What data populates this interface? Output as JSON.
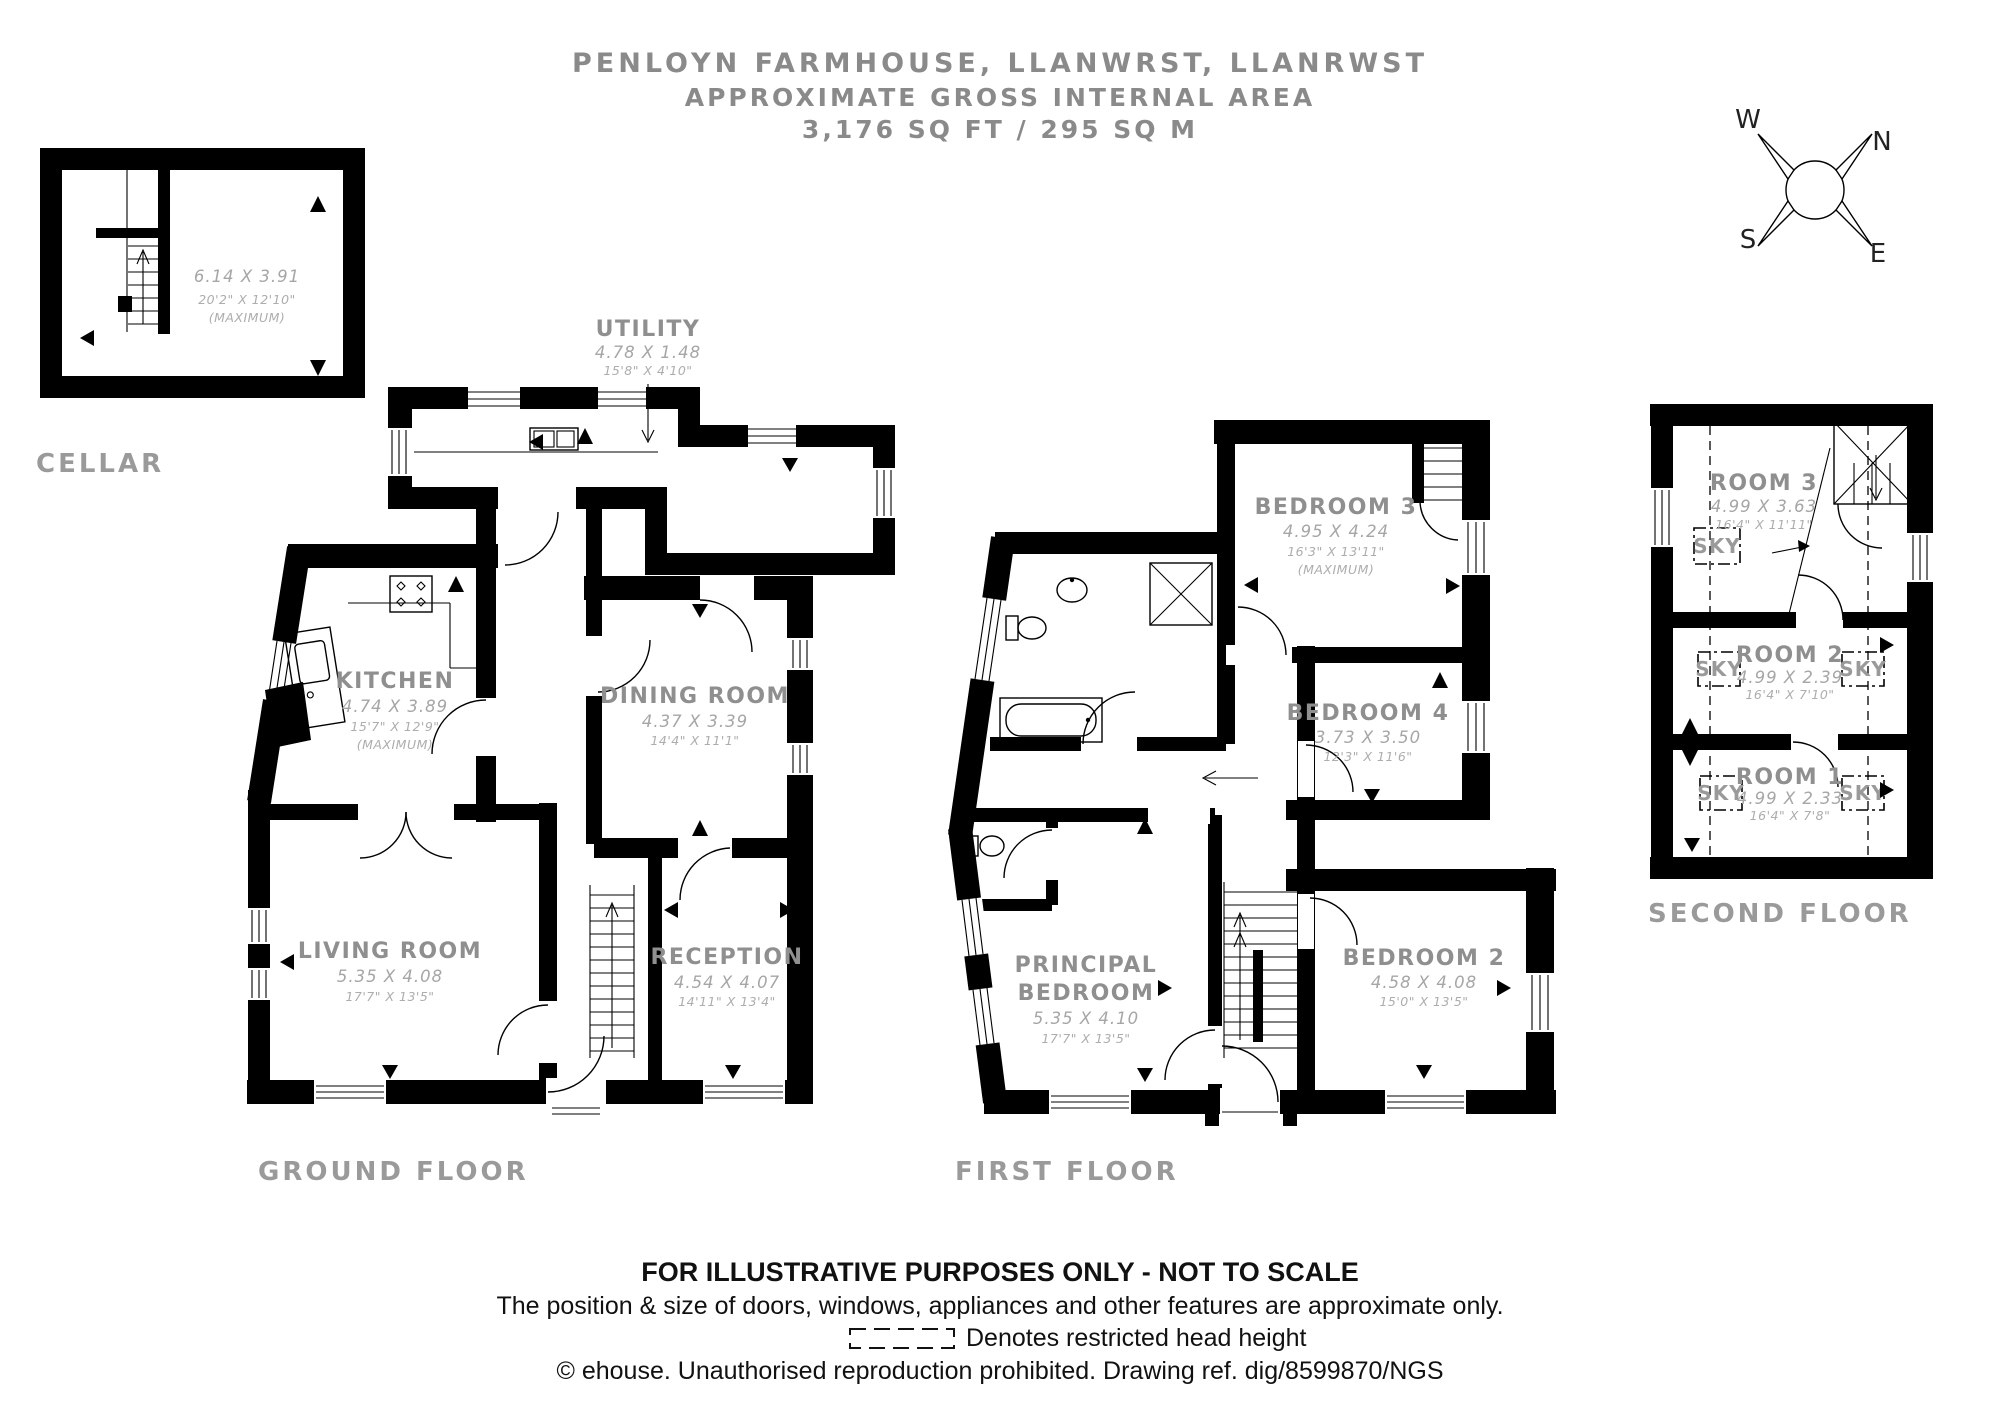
{
  "header": {
    "line1": "PENLOYN FARMHOUSE, LLANWRST, LLANRWST",
    "line2": "APPROXIMATE GROSS INTERNAL AREA",
    "line3": "3,176 SQ FT / 295 SQ M"
  },
  "compass": {
    "north": "N",
    "east": "E",
    "south": "S",
    "west": "W"
  },
  "cellar": {
    "label": "CELLAR",
    "metric": "6.14 X 3.91",
    "imperial": "20'2\" X 12'10\"",
    "note": "(MAXIMUM)"
  },
  "ground": {
    "label": "GROUND FLOOR",
    "utility": {
      "name": "UTILITY",
      "metric": "4.78 X 1.48",
      "imperial": "15'8\" X 4'10\""
    },
    "kitchen": {
      "name": "KITCHEN",
      "metric": "4.74 X 3.89",
      "imperial": "15'7\" X 12'9\"",
      "note": "(MAXIMUM)"
    },
    "dining": {
      "name": "DINING ROOM",
      "metric": "4.37 X 3.39",
      "imperial": "14'4\" X 11'1\""
    },
    "living": {
      "name": "LIVING ROOM",
      "metric": "5.35 X 4.08",
      "imperial": "17'7\" X 13'5\""
    },
    "reception": {
      "name": "RECEPTION",
      "metric": "4.54 X 4.07",
      "imperial": "14'11\" X 13'4\""
    }
  },
  "first": {
    "label": "FIRST FLOOR",
    "bedroom3": {
      "name": "BEDROOM 3",
      "metric": "4.95 X 4.24",
      "imperial": "16'3\" X 13'11\"",
      "note": "(MAXIMUM)"
    },
    "bedroom4": {
      "name": "BEDROOM 4",
      "metric": "3.73 X 3.50",
      "imperial": "12'3\" X 11'6\""
    },
    "principal": {
      "name_line1": "PRINCIPAL",
      "name_line2": "BEDROOM",
      "metric": "5.35 X 4.10",
      "imperial": "17'7\" X 13'5\""
    },
    "bedroom2": {
      "name": "BEDROOM 2",
      "metric": "4.58 X 4.08",
      "imperial": "15'0\" X 13'5\""
    }
  },
  "second": {
    "label": "SECOND FLOOR",
    "sky_label": "SKY",
    "room3": {
      "name": "ROOM 3",
      "metric": "4.99 X 3.63",
      "imperial": "16'4\" X 11'11\""
    },
    "room2": {
      "name": "ROOM 2",
      "metric": "4.99 X 2.39",
      "imperial": "16'4\" X 7'10\""
    },
    "room1": {
      "name": "ROOM 1",
      "metric": "4.99 X 2.33",
      "imperial": "16'4\" X 7'8\""
    }
  },
  "footer": {
    "line1": "FOR ILLUSTRATIVE PURPOSES ONLY - NOT TO SCALE",
    "line2": "The position & size of doors, windows, appliances and other features are approximate only.",
    "restricted_note": "Denotes restricted head height",
    "line4": "© ehouse. Unauthorised reproduction prohibited. Drawing ref. dig/8599870/NGS"
  },
  "colors": {
    "walls": "#000000",
    "room_label": "#8f8f8f",
    "dimension_text": "#a8a8a8",
    "floor_label": "#9a9a9a",
    "header_text": "#8a8a8a",
    "footer_text": "#111111",
    "background": "#ffffff"
  }
}
